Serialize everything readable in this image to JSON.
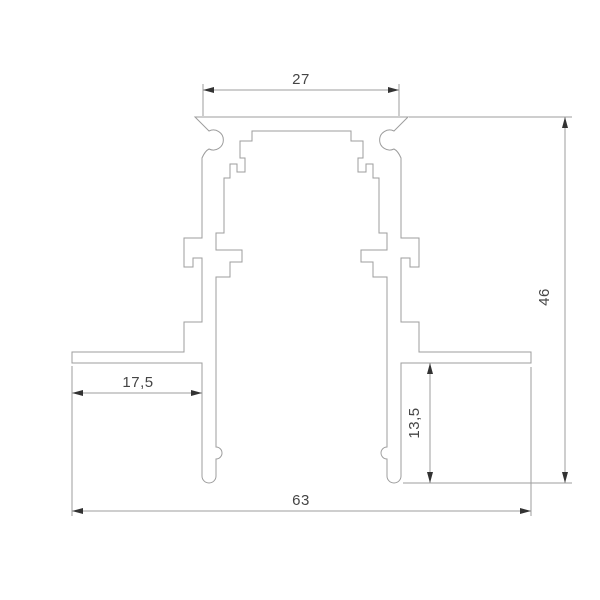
{
  "drawing": {
    "colors": {
      "background": "#ffffff",
      "line": "#9d9d9d",
      "arrow": "#333333",
      "text": "#454545"
    },
    "dimensions": {
      "top_width": {
        "label": "27"
      },
      "height": {
        "label": "46"
      },
      "flange_left_width": {
        "label": "17,5"
      },
      "recess_depth": {
        "label": "13,5"
      },
      "overall_width": {
        "label": "63"
      }
    }
  }
}
